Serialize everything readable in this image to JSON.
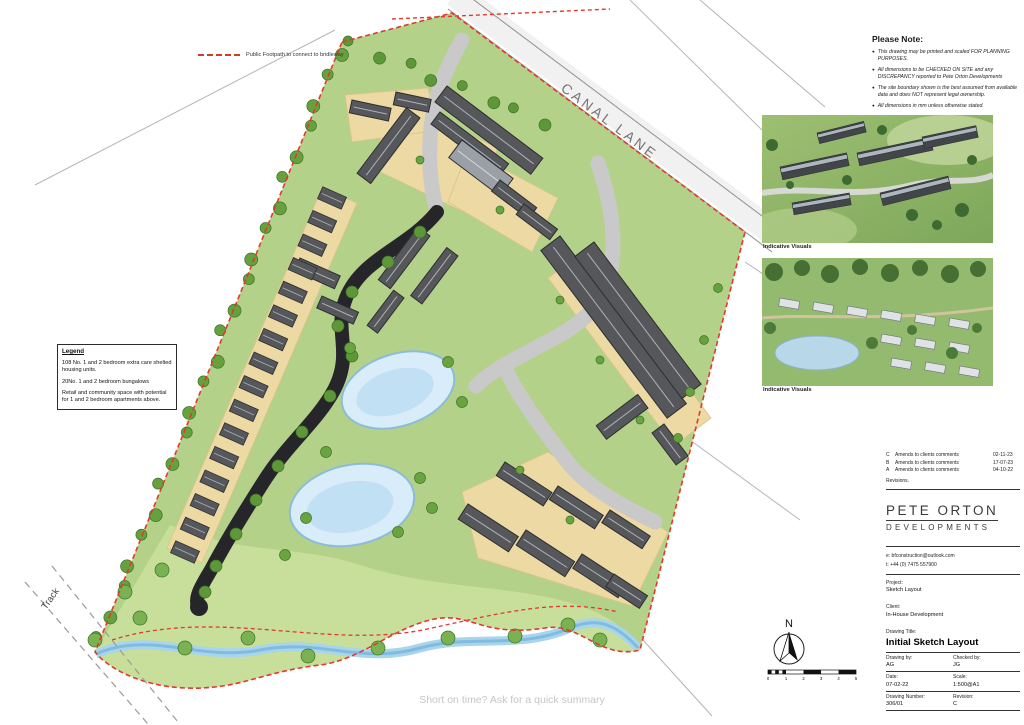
{
  "sheet": {
    "footer_note": "Short on time? Ask for a quick summary"
  },
  "plan": {
    "road_label": "CANAL LANE",
    "track_label": "Track",
    "footpath_legend": "Public Footpath to connect to bridleway"
  },
  "icons": {
    "bullet": "●"
  },
  "legend": {
    "title": "Legend",
    "item1": "108 No.  1 and 2 bedroom extra care shelted housing units.",
    "item2": "20No. 1 and 2 bedroom bungalows",
    "item3": "Retail and community space with potential for 1 and 2 bedroom apartments above."
  },
  "please_note": {
    "title": "Please Note:",
    "items": [
      "This drawing may be printed and scaled FOR PLANNING PURPOSES.",
      "All dimensions to be CHECKED ON SITE and any DISCREPANCY reported to Pete Orton Developments",
      "The site boundary shown is the best assumed from available data and does NOT represent legal ownership.",
      "All dimensions in mm unless otherwise stated."
    ]
  },
  "visuals": {
    "label1": "Indicative Visuals",
    "label2": "Indicative Visuals"
  },
  "title_block": {
    "revisions": [
      {
        "rev": "C",
        "desc": "Amends to clients comments",
        "date": "02-11-23"
      },
      {
        "rev": "B",
        "desc": "Amends to clients comments",
        "date": "17-07-23"
      },
      {
        "rev": "A",
        "desc": "Amends to clients comments",
        "date": "04-10-22"
      }
    ],
    "revisions_label": "Revisions.",
    "company_name": "PETE ORTON",
    "company_sub": "DEVELOPMENTS",
    "email": "e: bfconstruction@outlook.com",
    "phone": "t: +44 (0) 7475 557900",
    "project_label": "Project:",
    "project_value": "Sketch Layout",
    "client_label": "Client:",
    "client_value": "In-House Development",
    "drawing_title_label": "Drawing Title:",
    "drawing_title_value": "Initial Sketch Layout",
    "drawing_by_label": "Drawing by:",
    "drawing_by_value": "AG",
    "checked_by_label": "Checked by:",
    "checked_by_value": "JG",
    "date_label": "Date:",
    "date_value": "07-02-22",
    "scale_label": "Scale:",
    "scale_value": "1:500@A1",
    "drawing_number_label": "Drawing Number:",
    "drawing_number_value": "306/01",
    "revision_label": "Revision:",
    "revision_value": "C"
  },
  "compass": {
    "north_label": "N"
  },
  "scale_bar": {
    "ticks": [
      "0",
      "1",
      "2",
      "3",
      "4",
      "5"
    ]
  }
}
